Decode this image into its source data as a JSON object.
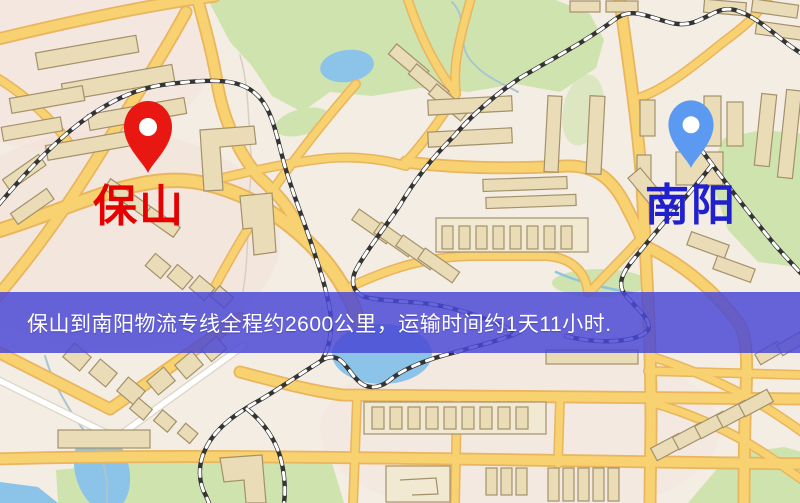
{
  "banner": {
    "text": "保山到南阳物流专线全程约2600公里，运输时间约1天11小时.",
    "background": "rgba(74,71,213,0.84)",
    "text_color": "#ffffff"
  },
  "markers": {
    "origin": {
      "label": "保山",
      "pin_icon": "map-pin-icon",
      "pin_color": "#e81712",
      "label_color": "#e60000"
    },
    "destination": {
      "label": "南阳",
      "pin_icon": "map-pin-icon",
      "pin_color": "#5b9af0",
      "label_color": "#2020cf"
    }
  },
  "map_palette": {
    "bg": "#f4ede3",
    "pink": "#f2d9d2",
    "road": "#f8d170",
    "roadCasing": "#e9b55e",
    "whiteRoad": "#ffffff",
    "whiteRoadCasing": "#ddd4c6",
    "bldg": "#e9dcb6",
    "bldgLight": "#f1e9d2",
    "bldgStroke": "#a3916b",
    "park": "#cfe3af",
    "water": "#8cc3e9",
    "stream": "#a9c6cf",
    "rail": "#343434",
    "railDash": "#ffffff",
    "bannerBg": "rgba(74,71,213,0.84)",
    "bannerText": "#ffffff",
    "originPin": "#e81712",
    "originText": "#e60000",
    "destPin": "#5b9af0",
    "destText": "#2020cf"
  }
}
